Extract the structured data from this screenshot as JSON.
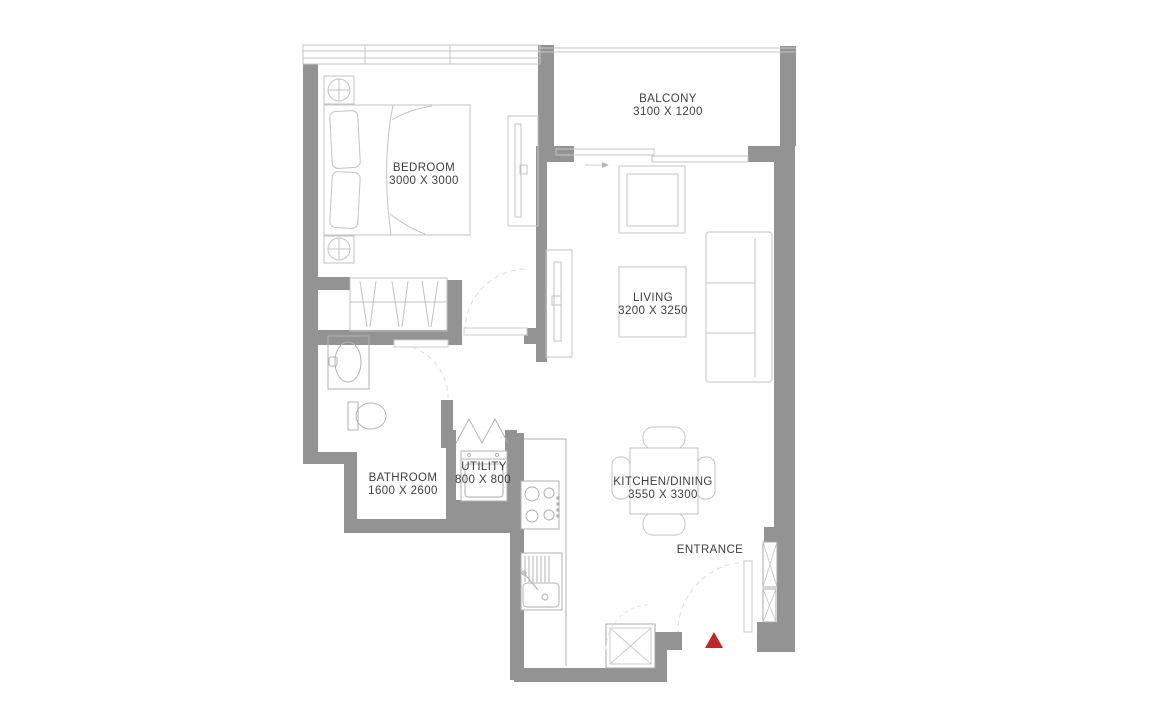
{
  "floor_plan": {
    "colors": {
      "wall": "#939393",
      "furniture": "#c3c3c3",
      "appliance": "#b2b2b2",
      "text": "#404040",
      "entrance_marker": "#c4252b"
    },
    "rooms": {
      "bedroom": {
        "name": "BEDROOM",
        "dimensions": "3000 X 3000"
      },
      "balcony": {
        "name": "BALCONY",
        "dimensions": "3100 X 1200"
      },
      "living": {
        "name": "LIVING",
        "dimensions": "3200 X 3250"
      },
      "bathroom": {
        "name": "BATHROOM",
        "dimensions": "1600 X 2600"
      },
      "utility": {
        "name": "UTILITY",
        "dimensions": "800 X 800"
      },
      "kitchen_dining": {
        "name": "KITCHEN/DINING",
        "dimensions": "3550 X 3300"
      },
      "entrance": {
        "name": "ENTRANCE"
      }
    }
  }
}
